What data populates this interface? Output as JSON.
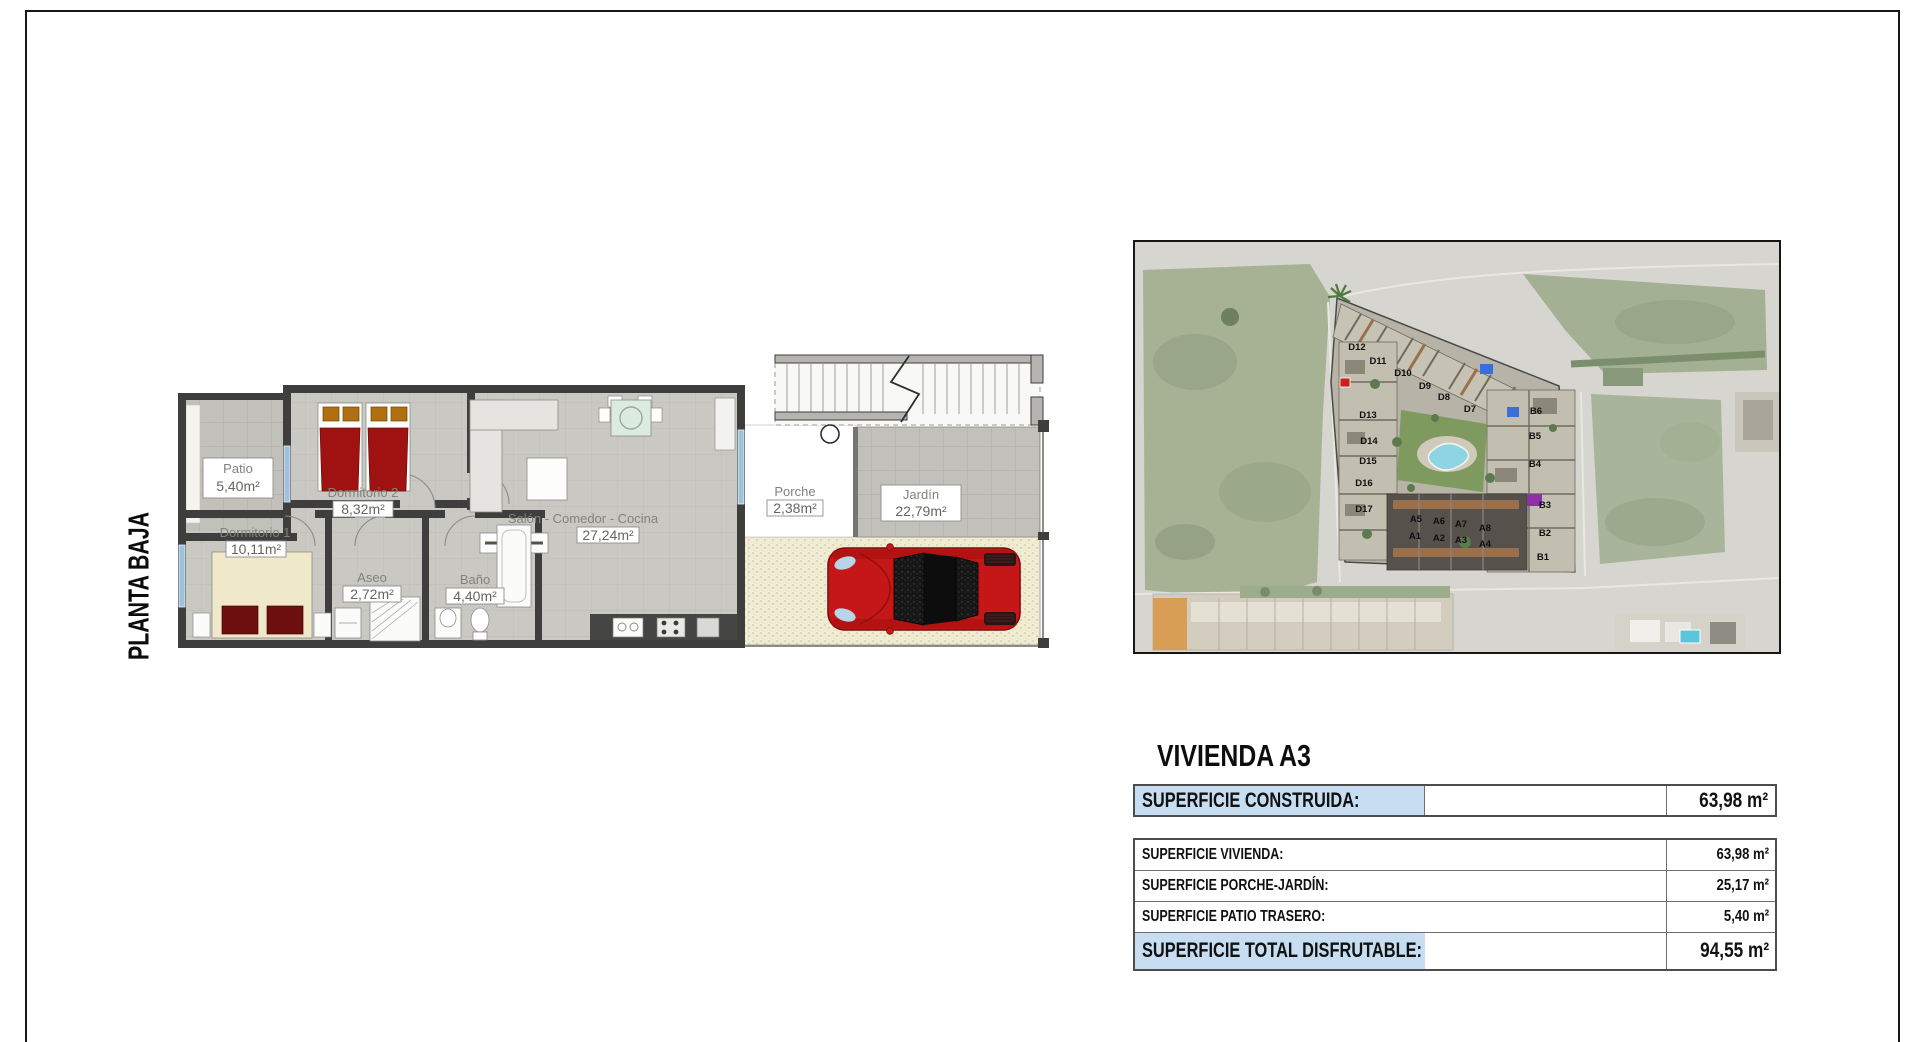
{
  "page": {
    "floor_label": "PLANTA BAJA"
  },
  "plan": {
    "rooms": {
      "patio": {
        "name": "Patio",
        "area": "5,40m²"
      },
      "dormitorio2": {
        "name": "Dormitorio 2",
        "area": "8,32m²"
      },
      "dormitorio1": {
        "name": "Dormitorio 1",
        "area": "10,11m²"
      },
      "aseo": {
        "name": "Aseo",
        "area": "2,72m²"
      },
      "bano": {
        "name": "Baño",
        "area": "4,40m²"
      },
      "salon": {
        "name": "Salón - Comedor - Cocina",
        "area": "27,24m²"
      },
      "porche": {
        "name": "Porche",
        "area": "2,38m²"
      },
      "jardin": {
        "name": "Jardín",
        "area": "22,79m²"
      }
    }
  },
  "map": {
    "units": [
      "D12",
      "D11",
      "D10",
      "D9",
      "D8",
      "D7",
      "D13",
      "D14",
      "D15",
      "D16",
      "D17",
      "B6",
      "B5",
      "B4",
      "B3",
      "B2",
      "B1",
      "A5",
      "A6",
      "A7",
      "A8",
      "A1",
      "A2",
      "A3",
      "A4"
    ]
  },
  "summary": {
    "title": "VIVIENDA A3",
    "accent_color": "#c6ddf2",
    "highlight_row": {
      "label": "SUPERFICIE CONSTRUIDA:",
      "value": "63,98 m²"
    },
    "rows": [
      {
        "label": "SUPERFICIE VIVIENDA:",
        "value": "63,98 m²"
      },
      {
        "label": "SUPERFICIE PORCHE-JARDÍN:",
        "value": "25,17 m²"
      },
      {
        "label": "SUPERFICIE PATIO TRASERO:",
        "value": "5,40 m²"
      }
    ],
    "total_row": {
      "label": "SUPERFICIE TOTAL DISFRUTABLE:",
      "value": "94,55 m²"
    }
  }
}
